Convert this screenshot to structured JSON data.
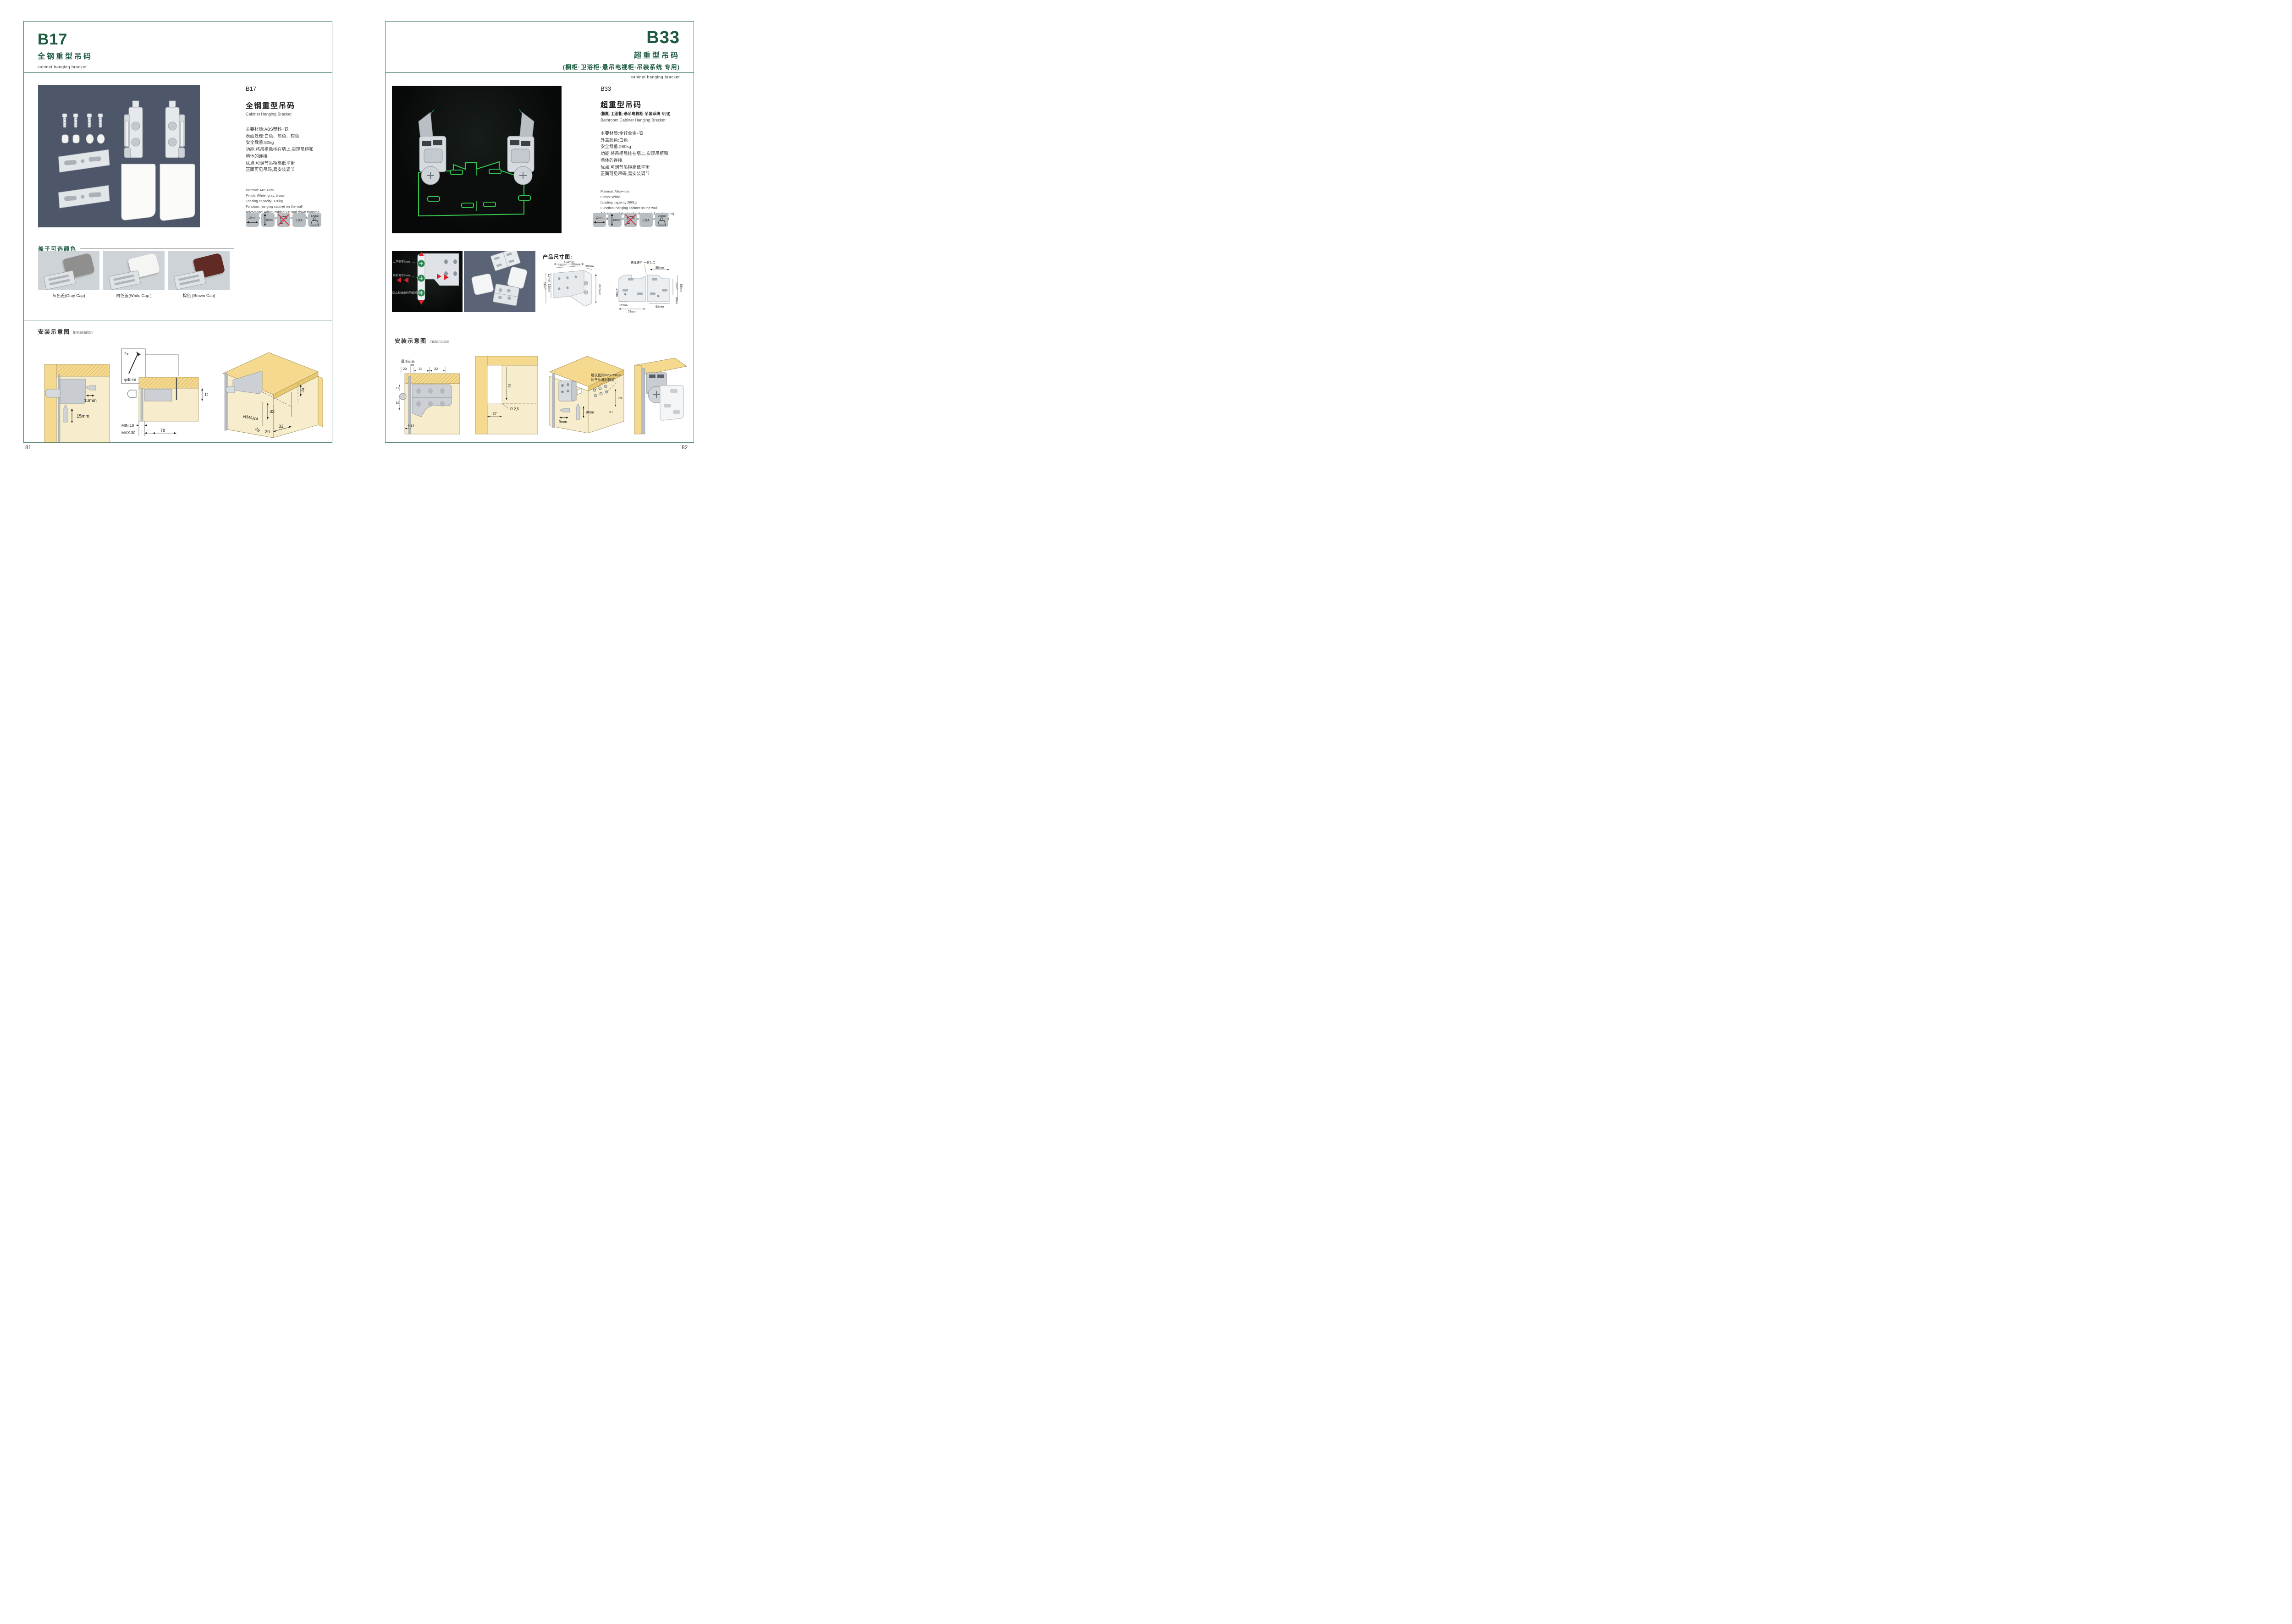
{
  "left": {
    "code": "B17",
    "title_cn": "全钢重型吊码",
    "title_en": "cabinet hanging bracket",
    "col": {
      "code": "B17",
      "name_cn": "全钢重型吊码",
      "name_en": "Cabinet Hanging Bracket"
    },
    "specs_cn": [
      "主要材质:ABS塑料+铁",
      "表面处理:白色、灰色、棕色",
      "安全载重:80kg",
      "功能:将吊柜悬挂在墙上,实现吊柜和",
      "墙体的连接",
      "优点:可调节吊柜高低平衡",
      "正面可见吊码,易安装调节"
    ],
    "specs_en": [
      "Material: ABS+iron",
      "Finish: White, gray, brown",
      "Loading capacity: 120kg",
      "Function: hanging cabinet on the wall",
      "Advantage: Adjust cabinet up and down hanging",
      "bracket is visible, easy to adjust and installed"
    ],
    "icons": {
      "width": "10mm",
      "height": "15mm",
      "cert": "LGA",
      "load": "120Kg"
    },
    "caps": {
      "title": "盖子可选颜色",
      "items": [
        {
          "label": "灰色盖(Gray Cap)",
          "color": "#8f8f8d"
        },
        {
          "label": "白色盖(White Cap )",
          "color": "#f5f5f3"
        },
        {
          "label": "棕色 (Brown Cap)",
          "color": "#5f2b24"
        }
      ]
    },
    "install": {
      "cn": "安装示意图",
      "en": "Installation"
    },
    "d1": {
      "w": "10mm",
      "h": "15mm"
    },
    "d2": {
      "qty": "2x",
      "dia": "φ4mm",
      "t": "13",
      "min": "MIN.10",
      "max": "MAX.30",
      "depth": "78"
    },
    "d3": {
      "a": "34",
      "b": "32",
      "r": "RMAX4",
      "c": "18",
      "d": "20",
      "e": "32"
    },
    "page_number": "81"
  },
  "right": {
    "code": "B33",
    "title_cn": "超重型吊码",
    "title_sub": "(橱柜·卫浴柜·悬吊电视柜·吊装系统 专用)",
    "title_en": "cabinet hanging bracket",
    "col": {
      "code": "B33",
      "name_cn": "超重型吊码",
      "name_sub": "(橱柜·卫浴柜·悬吊电视柜·吊装系统 专用)",
      "name_en": "Bathroom Cabinet Hanging Bracket"
    },
    "specs_cn": [
      "主要材质:全锌合金+铁",
      "外盖颜色:白色",
      "安全载重:260kg",
      "功能:将吊柜悬挂在墙上,实现吊柜和",
      "墙体的连接",
      "优点:可调节吊柜高低平衡",
      "正面可见吊码,易安装调节"
    ],
    "specs_en": [
      "Material: Alloy+iron",
      "Finish: White",
      "Loading capacity:260kg",
      "Function: hanging cabinet on the wall",
      "Advantage: Adjust cabinet up and down hanging",
      "bracket is visible, easy to adjust and installed"
    ],
    "icons": {
      "width": "12mm",
      "height": "13mm",
      "cert": "LGA",
      "load": "260Kg"
    },
    "photo1_notes": [
      "上下调节9mm",
      "前后调节9mm",
      "防止柜体翻转的锁紧螺丝"
    ],
    "dims_title": "产品尺寸图:",
    "dimsA": {
      "w": "104mm",
      "p1": "32mm",
      "p2": "32mm",
      "d": "39mm",
      "h": "80.5mm",
      "l1": "11mm",
      "l2": "32mm",
      "l3": "51mm"
    },
    "dimsB": {
      "note": "连体挂片 一分为二",
      "top": "55mm",
      "r1": "39mm",
      "r2": "55mm",
      "r3": "8mm",
      "l1": "17mm",
      "b1": "12mm",
      "b2": "63mm",
      "b3": "77mm"
    },
    "install": {
      "cn": "安装示意图",
      "en": "Installation"
    },
    "d1": {
      "note": "最小间距",
      "v1": "20",
      "v2": "10",
      "v3": "32",
      "v4": "32",
      "v5": "11",
      "v6": "32",
      "v7": "4-14"
    },
    "d2": {
      "v1": "78",
      "v2": "R 2,5",
      "v3": "37"
    },
    "d3": {
      "note1": "建议使用M6x12mm",
      "note2": "的平头螺丝固定",
      "v1": "9mm",
      "v2": "9mm",
      "v3": "78",
      "v4": "37"
    },
    "page_number": "82"
  }
}
